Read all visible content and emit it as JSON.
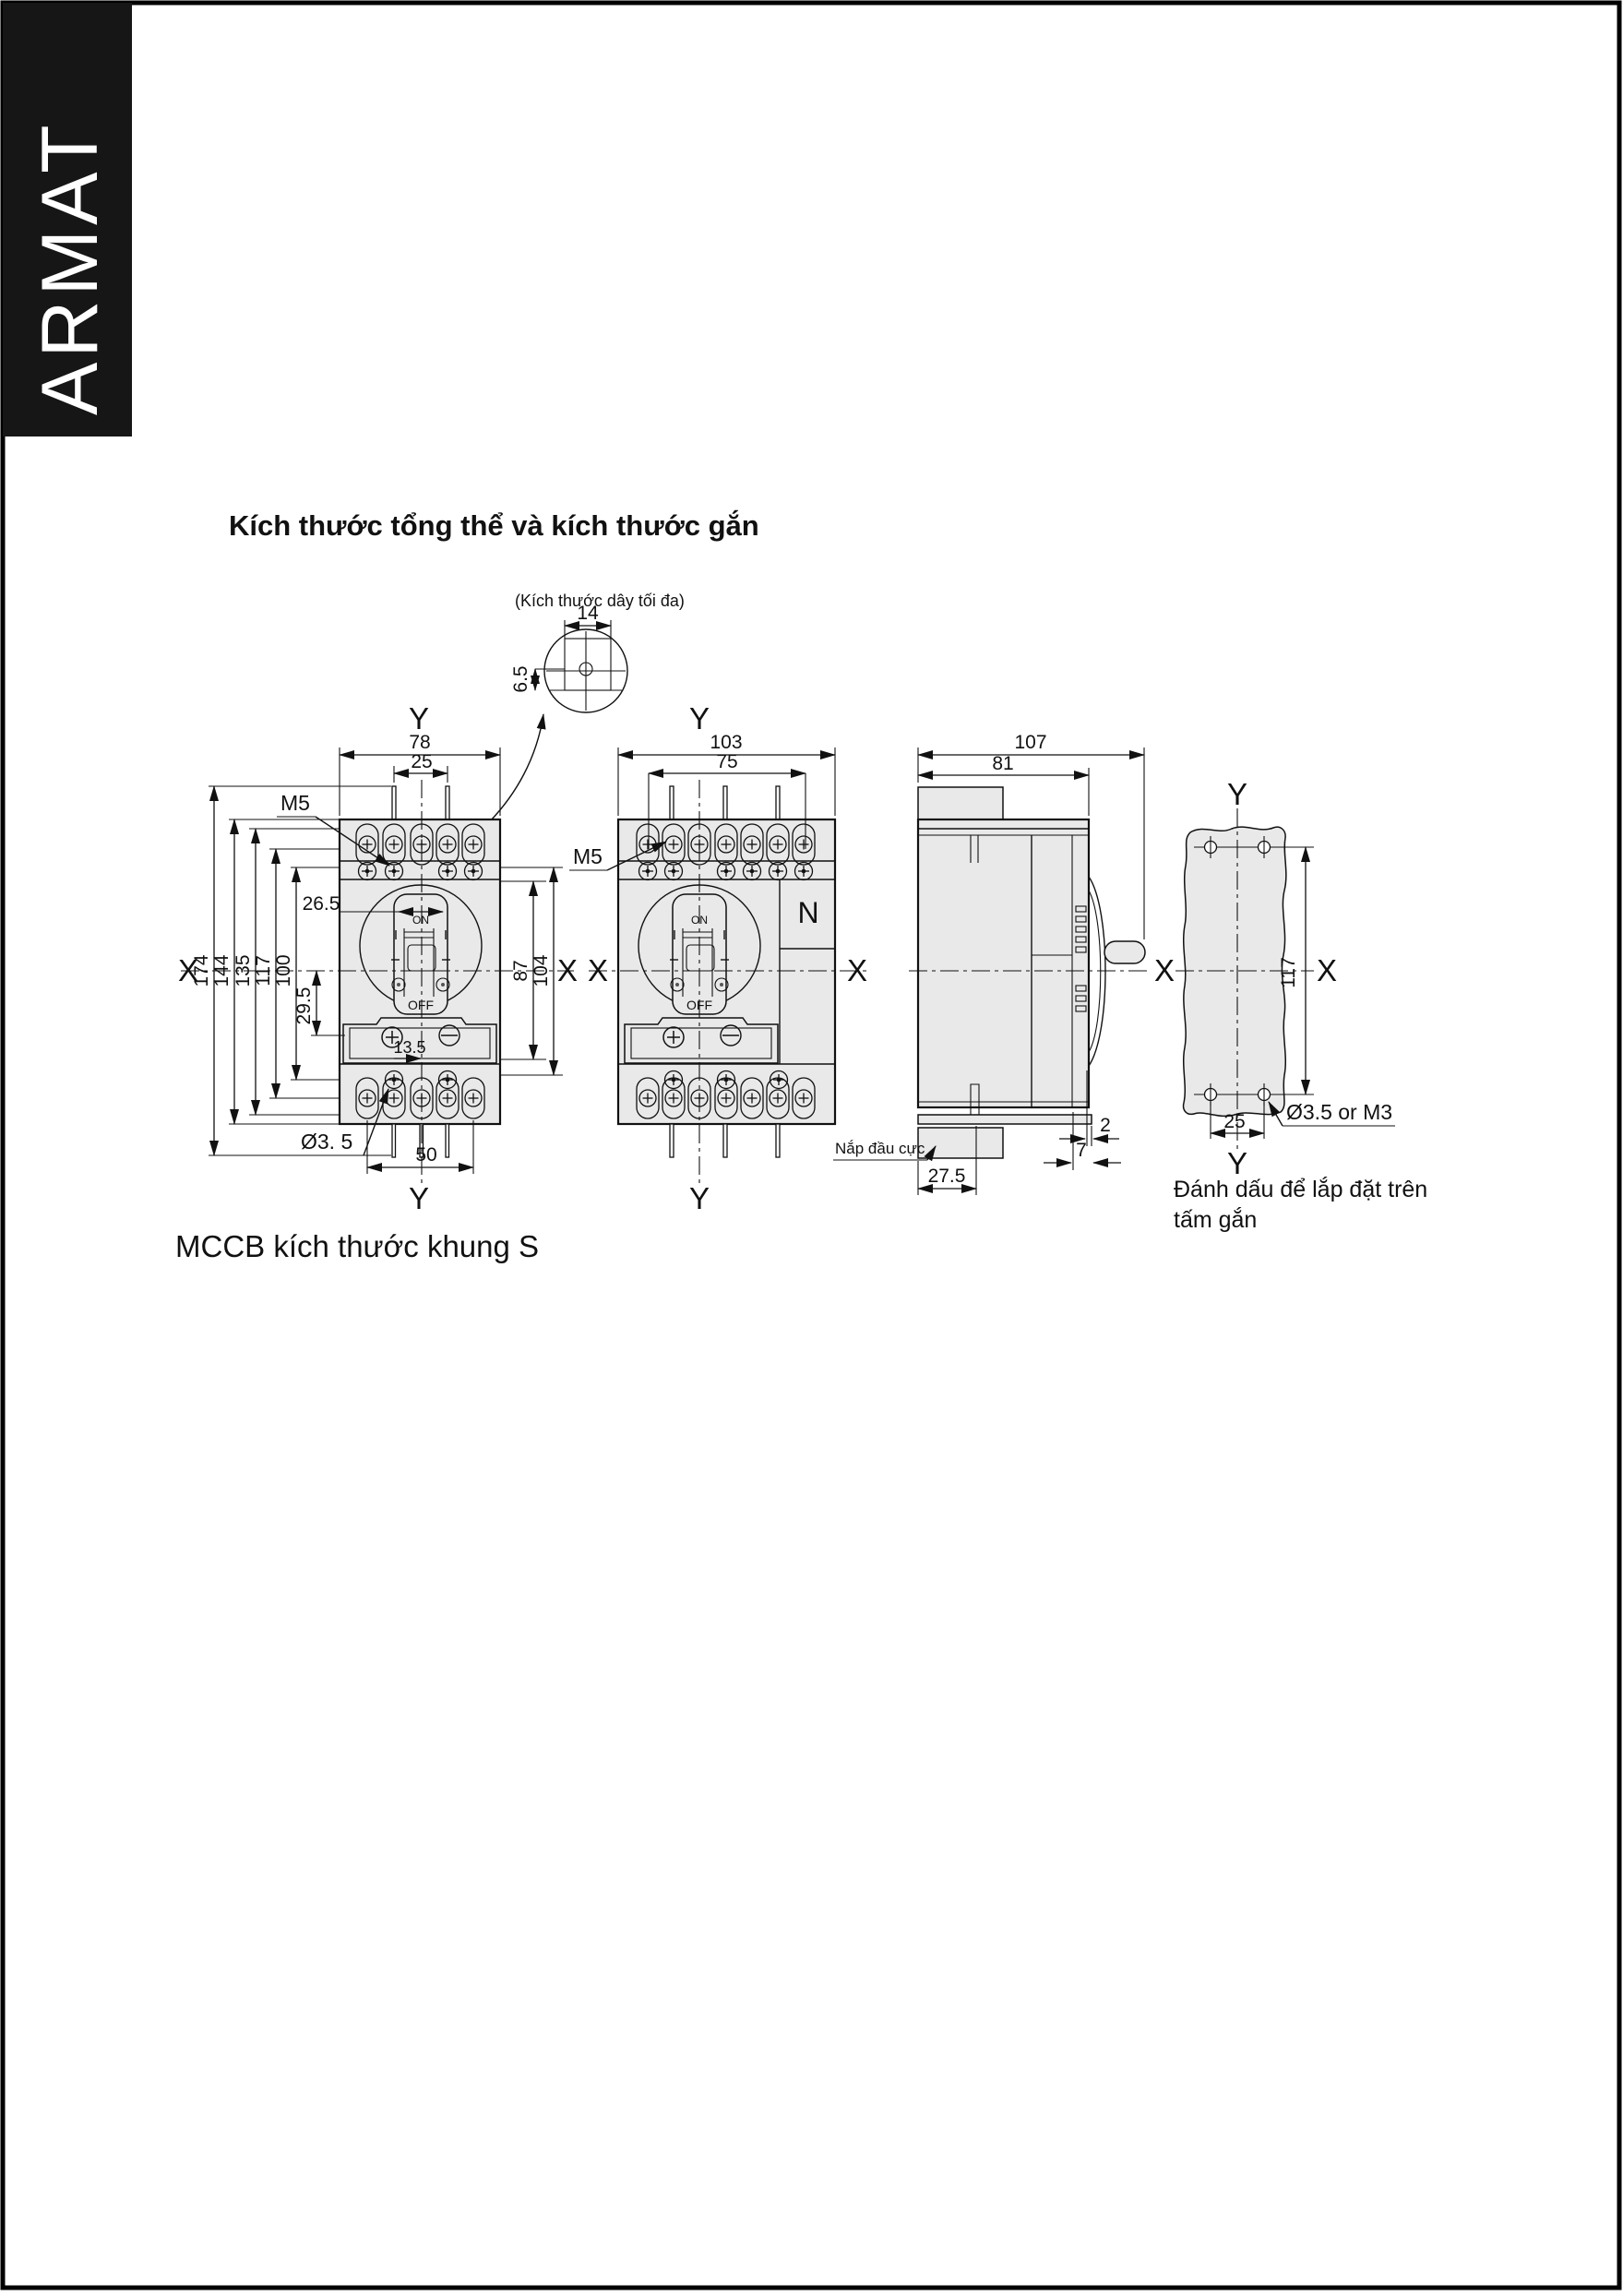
{
  "page": {
    "brand": "ARMAT",
    "title": "Kích thước tổng thể và kích thước gắn",
    "footer": "MCCB kích thước khung S"
  },
  "axis": {
    "x": "X",
    "y": "Y"
  },
  "labels": {
    "m5": "M5",
    "on": "ON",
    "off": "OFF",
    "n": "N",
    "terminal_cover": "Nắp đầu cực",
    "mount_hole": "Ø3.5 or M3",
    "foot_hole": "Ø3. 5",
    "wire_note": "(Kích thước dây tối đa)",
    "plate_caption_line1": "Đánh dấu để lắp đặt trên",
    "plate_caption_line2": "tấm gắn"
  },
  "dims": {
    "detail": {
      "w": "14",
      "h": "6.5"
    },
    "front3p": {
      "overall_w": "78",
      "lead_pitch": "25",
      "h_overall": "174",
      "h_case": "144",
      "h_135": "135",
      "h_117": "117",
      "h_100": "100",
      "h_trip": "29.5",
      "toggle_w": "26.5",
      "h_87": "87",
      "h_104": "104",
      "screw_off": "13.5",
      "mount_w": "50"
    },
    "front4p": {
      "overall_w": "103",
      "mount_w": "75"
    },
    "side": {
      "depth": "107",
      "depth_body": "81",
      "plate_t": "2",
      "gap": "7",
      "cover_d": "27.5"
    },
    "plate": {
      "hole_v": "117",
      "hole_h": "25"
    }
  }
}
